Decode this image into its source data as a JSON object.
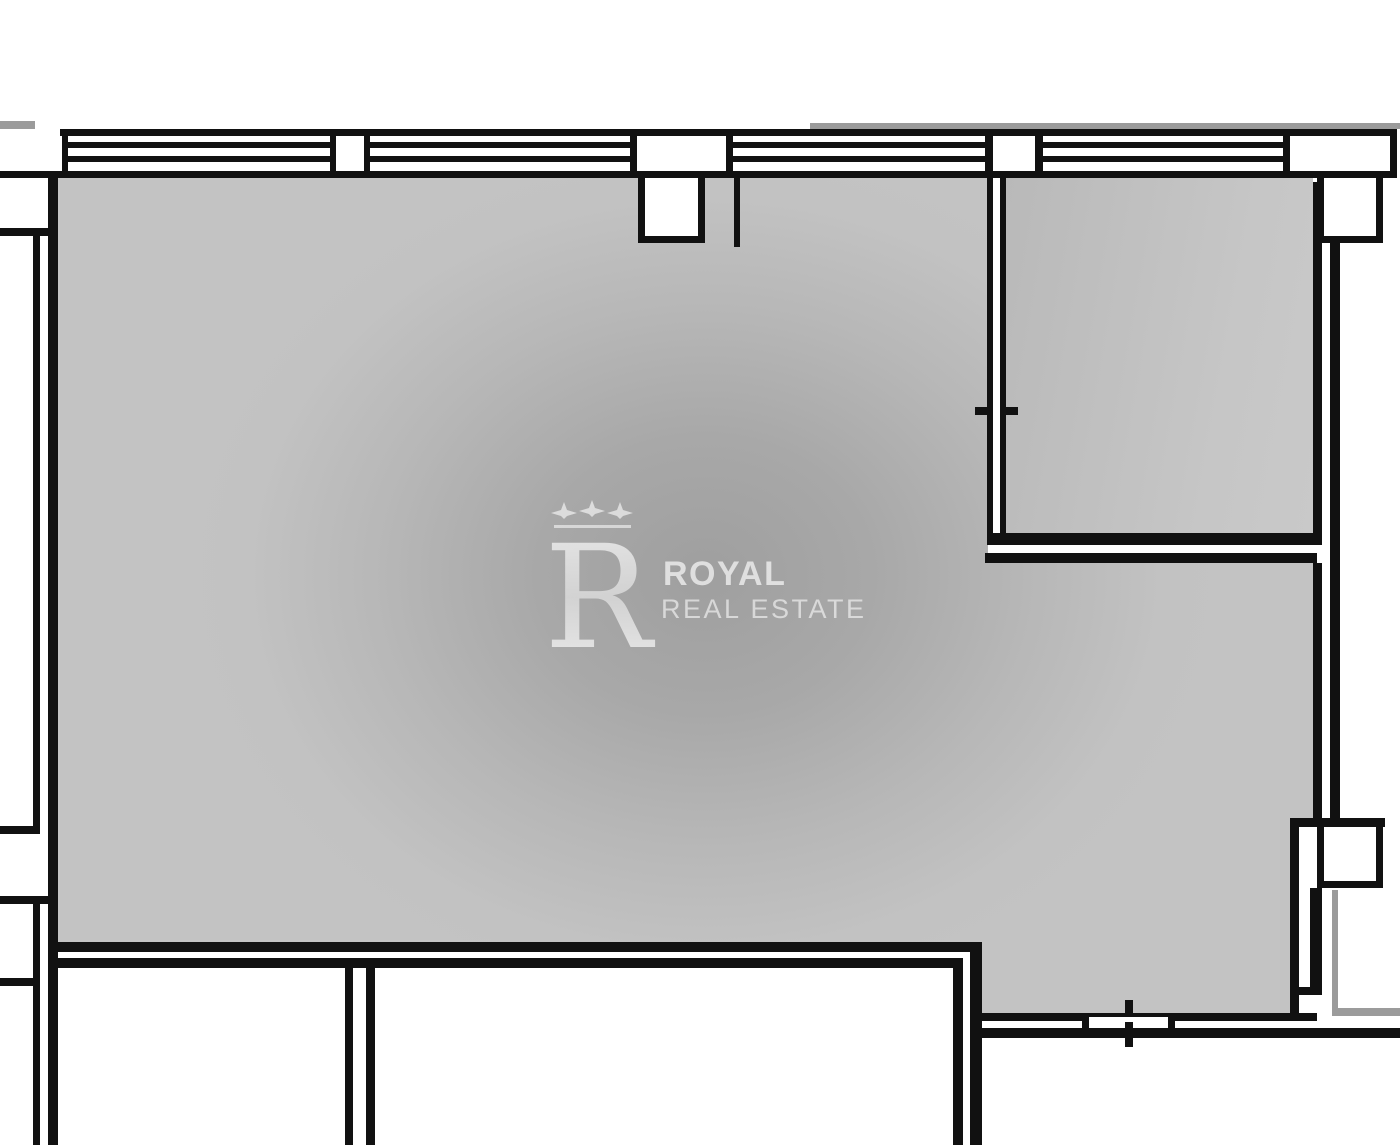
{
  "watermark": {
    "brand_top": "ROYAL",
    "brand_bottom": "REAL ESTATE",
    "logo": "royal-r-monogram",
    "logo_stars_count": 3
  },
  "colors": {
    "wall_black": "#111111",
    "floor_gray": "#c2c2c2",
    "floor_shadow_center": "#9f9f9f",
    "exterior_gray_line": "#9b9b9b",
    "background": "#ffffff",
    "watermark_text": "#d8d8d8"
  },
  "plan": {
    "type": "floor-plan",
    "canvas": [
      1400,
      1145
    ],
    "gray_area_polygon": [
      [
        57,
        177
      ],
      [
        988,
        177
      ],
      [
        988,
        563
      ],
      [
        1313,
        563
      ],
      [
        1313,
        818
      ],
      [
        1290,
        818
      ],
      [
        1290,
        1013
      ],
      [
        982,
        1013
      ],
      [
        982,
        942
      ],
      [
        57,
        942
      ]
    ],
    "room2_rect": [
      1006,
      178,
      307,
      355
    ],
    "walls_black": [
      [
        60,
        129,
        1337,
        7
      ],
      [
        0,
        171,
        1397,
        7
      ],
      [
        68,
        142,
        262,
        6
      ],
      [
        68,
        156,
        262,
        6
      ],
      [
        370,
        142,
        260,
        6
      ],
      [
        370,
        156,
        260,
        6
      ],
      [
        733,
        142,
        252,
        6
      ],
      [
        733,
        156,
        252,
        6
      ],
      [
        1043,
        142,
        240,
        6
      ],
      [
        1043,
        156,
        240,
        6
      ],
      [
        62,
        129,
        6,
        49
      ],
      [
        330,
        129,
        6,
        49
      ],
      [
        364,
        129,
        6,
        49
      ],
      [
        630,
        129,
        7,
        49
      ],
      [
        726,
        129,
        7,
        49
      ],
      [
        985,
        129,
        8,
        49
      ],
      [
        1035,
        129,
        8,
        49
      ],
      [
        1283,
        129,
        7,
        49
      ],
      [
        1390,
        129,
        7,
        49
      ],
      [
        48,
        171,
        10,
        974
      ],
      [
        33,
        232,
        7,
        600
      ],
      [
        33,
        900,
        7,
        245
      ],
      [
        0,
        228,
        48,
        8
      ],
      [
        0,
        826,
        40,
        8
      ],
      [
        0,
        896,
        48,
        8
      ],
      [
        0,
        978,
        38,
        8
      ],
      [
        48,
        942,
        934,
        10
      ],
      [
        57,
        958,
        906,
        10
      ],
      [
        345,
        958,
        8,
        187
      ],
      [
        366,
        958,
        9,
        187
      ],
      [
        953,
        958,
        10,
        187
      ],
      [
        970,
        942,
        12,
        203
      ],
      [
        982,
        1013,
        335,
        8
      ],
      [
        982,
        1028,
        418,
        10
      ],
      [
        1082,
        1013,
        7,
        25
      ],
      [
        1168,
        1013,
        7,
        25
      ],
      [
        1125,
        1000,
        8,
        47
      ],
      [
        987,
        178,
        6,
        355
      ],
      [
        1000,
        178,
        6,
        355
      ],
      [
        987,
        365,
        19,
        7
      ],
      [
        987,
        452,
        19,
        7
      ],
      [
        975,
        407,
        43,
        8
      ],
      [
        987,
        533,
        335,
        12
      ],
      [
        1313,
        182,
        9,
        351
      ],
      [
        985,
        553,
        332,
        10
      ],
      [
        1330,
        243,
        10,
        575
      ],
      [
        1290,
        818,
        95,
        9
      ],
      [
        1313,
        563,
        9,
        255
      ],
      [
        1290,
        827,
        9,
        186
      ],
      [
        1310,
        888,
        12,
        104
      ],
      [
        1292,
        987,
        30,
        8
      ],
      [
        734,
        178,
        6,
        69
      ]
    ],
    "lines_gray": [
      [
        0,
        121,
        35,
        8
      ],
      [
        810,
        123,
        590,
        6
      ],
      [
        1332,
        890,
        6,
        120
      ],
      [
        1332,
        1008,
        68,
        8
      ]
    ],
    "boxes_white": [
      {
        "x": 993,
        "y": 178,
        "w": 7,
        "h": 355,
        "borders": ""
      },
      {
        "x": 1089,
        "y": 1017,
        "w": 79,
        "h": 5,
        "borders": ""
      },
      {
        "x": 638,
        "y": 178,
        "w": 67,
        "h": 65,
        "borders": "lrb"
      },
      {
        "x": 1317,
        "y": 178,
        "w": 66,
        "h": 65,
        "borders": "lrb"
      },
      {
        "x": 1317,
        "y": 827,
        "w": 66,
        "h": 61,
        "borders": "lrb"
      }
    ]
  }
}
